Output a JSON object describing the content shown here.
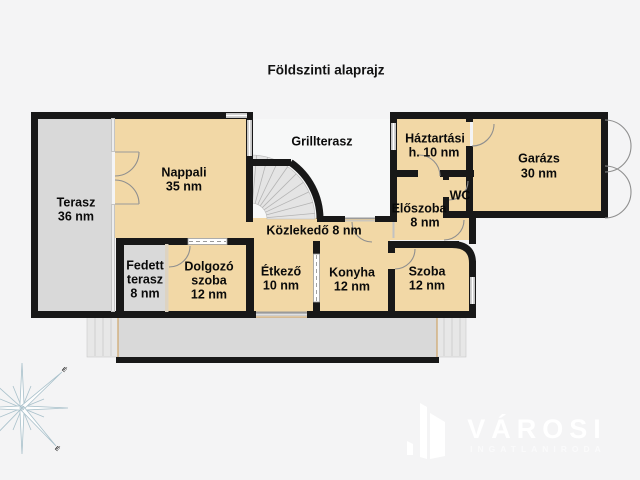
{
  "title": "Földszinti alaprajz",
  "compass": {
    "north_mark": "É"
  },
  "watermark": {
    "brand": "VÁROSI",
    "tagline": "INGATLANIRODA"
  },
  "colors": {
    "background": "#f4f4f5",
    "room": "#f2d8a6",
    "terrace": "#d9d9d9",
    "grill_terrace": "#f7f8f8",
    "stairs": "#e4e4e4",
    "wall": "#181818",
    "window": "#c6c6c6",
    "compass": "#a9c1cb",
    "watermark": "#ffffff"
  },
  "rooms": {
    "terasz": {
      "name": "Terasz",
      "area": "36 nm"
    },
    "nappali": {
      "name": "Nappali",
      "area": "35 nm"
    },
    "grillterasz": {
      "name": "Grillterasz"
    },
    "haztartasi": {
      "name": "Háztartási",
      "area": "h. 10 nm"
    },
    "garazs": {
      "name": "Garázs",
      "area": "30 nm"
    },
    "wc": {
      "name": "WC"
    },
    "eloszoba": {
      "name": "Előszoba",
      "area": "8 nm"
    },
    "kozlekedo": {
      "name": "Közlekedő 8 nm"
    },
    "fedett_terasz": {
      "name": "Fedett",
      "name2": "terasz",
      "area": "8 nm"
    },
    "dolgozo": {
      "name": "Dolgozó",
      "name2": "szoba",
      "area": "12 nm"
    },
    "etkezo": {
      "name": "Étkező",
      "area": "10 nm"
    },
    "konyha": {
      "name": "Konyha",
      "area": "12 nm"
    },
    "szoba": {
      "name": "Szoba",
      "area": "12 nm"
    }
  }
}
